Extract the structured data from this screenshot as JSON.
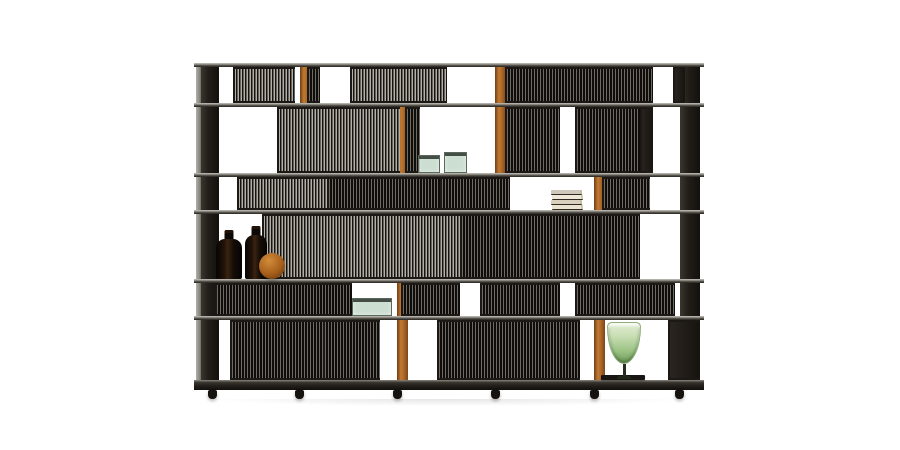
{
  "image_kind": "product-photograph",
  "subject": "modular slatted shelving room divider with decor objects on white background",
  "palette": {
    "background": "#ffffff",
    "frame_dark": "#2b2722",
    "end_panel": "#1f1b17",
    "shelf_top": "#c6c3bc",
    "shelf_face": "#55514b",
    "plinth": "#211d18",
    "slat_light": "#b2afa8",
    "slat_mid": "#6f6b63",
    "slat_gap": "#0f0d0b",
    "accent_orange": "#b06a2a",
    "bottle_glass": "#1a0f07",
    "wood_sphere": "#a9611c",
    "glass_teal": "#aac6b2",
    "book_cream": "#efe8d8",
    "vase_green": "#9cc384"
  },
  "scene": {
    "unit": {
      "left": 196,
      "top": 63,
      "width": 504,
      "height": 340
    },
    "uprights_dark": [
      {
        "x": 104,
        "w": 4
      },
      {
        "x": 201,
        "w": 4
      },
      {
        "x": 299,
        "w": 4
      },
      {
        "x": 398,
        "w": 4
      }
    ],
    "uprights_light": [
      {
        "x": 0,
        "w": 6
      }
    ],
    "end_panels": [
      {
        "x": 5,
        "w": 18
      },
      {
        "x": 484,
        "w": 20
      }
    ],
    "orange_posts": [
      {
        "x": 104,
        "y": 4,
        "h": 36
      },
      {
        "x": 104,
        "y": 151,
        "h": 102
      },
      {
        "x": 299,
        "y": 4,
        "h": 106
      },
      {
        "x": 201,
        "y": 44,
        "h": 103
      },
      {
        "x": 201,
        "y": 220,
        "h": 97
      },
      {
        "x": 398,
        "y": 114,
        "h": 203
      }
    ],
    "panels": [
      {
        "x": 37,
        "y": 4,
        "w": 62,
        "h": 36,
        "tone": "silver"
      },
      {
        "x": 111,
        "y": 4,
        "w": 13,
        "h": 36,
        "tone": "dark"
      },
      {
        "x": 154,
        "y": 4,
        "w": 97,
        "h": 36,
        "tone": "silver"
      },
      {
        "x": 309,
        "y": 4,
        "w": 148,
        "h": 36,
        "tone": "dark"
      },
      {
        "x": 477,
        "y": 4,
        "w": 12,
        "h": 36,
        "tone": "solid"
      },
      {
        "x": 81,
        "y": 44,
        "w": 123,
        "h": 66,
        "tone": "silver"
      },
      {
        "x": 209,
        "y": 44,
        "w": 15,
        "h": 66,
        "tone": "dark"
      },
      {
        "x": 309,
        "y": 44,
        "w": 55,
        "h": 66,
        "tone": "dark"
      },
      {
        "x": 379,
        "y": 44,
        "w": 65,
        "h": 66,
        "tone": "dark"
      },
      {
        "x": 444,
        "y": 44,
        "w": 13,
        "h": 66,
        "tone": "solid"
      },
      {
        "x": 41,
        "y": 114,
        "w": 90,
        "h": 33,
        "tone": "silver"
      },
      {
        "x": 131,
        "y": 114,
        "w": 113,
        "h": 33,
        "tone": "dark"
      },
      {
        "x": 244,
        "y": 114,
        "w": 70,
        "h": 33,
        "tone": "dark"
      },
      {
        "x": 406,
        "y": 114,
        "w": 48,
        "h": 33,
        "tone": "dark"
      },
      {
        "x": 66,
        "y": 151,
        "w": 198,
        "h": 65,
        "tone": "silver"
      },
      {
        "x": 264,
        "y": 151,
        "w": 140,
        "h": 65,
        "tone": "dark"
      },
      {
        "x": 404,
        "y": 151,
        "w": 40,
        "h": 65,
        "tone": "dark"
      },
      {
        "x": 19,
        "y": 220,
        "w": 137,
        "h": 33,
        "tone": "dark"
      },
      {
        "x": 205,
        "y": 220,
        "w": 59,
        "h": 33,
        "tone": "dark"
      },
      {
        "x": 284,
        "y": 220,
        "w": 80,
        "h": 33,
        "tone": "dark"
      },
      {
        "x": 379,
        "y": 220,
        "w": 100,
        "h": 33,
        "tone": "dark"
      },
      {
        "x": 34,
        "y": 257,
        "w": 93,
        "h": 60,
        "tone": "dark"
      },
      {
        "x": 127,
        "y": 257,
        "w": 57,
        "h": 60,
        "tone": "dark"
      },
      {
        "x": 241,
        "y": 257,
        "w": 143,
        "h": 60,
        "tone": "dark"
      },
      {
        "x": 472,
        "y": 257,
        "w": 32,
        "h": 60,
        "tone": "solid"
      }
    ],
    "shelves": [
      {
        "y": 0,
        "h": 4,
        "kind": "shelf"
      },
      {
        "y": 40,
        "h": 4,
        "kind": "shelf"
      },
      {
        "y": 110,
        "h": 4,
        "kind": "shelf"
      },
      {
        "y": 147,
        "h": 4,
        "kind": "shelf"
      },
      {
        "y": 216,
        "h": 4,
        "kind": "shelf"
      },
      {
        "y": 253,
        "h": 4,
        "kind": "shelf"
      },
      {
        "y": 317,
        "h": 10,
        "kind": "plinth"
      }
    ],
    "feet": [
      {
        "x": 12
      },
      {
        "x": 99
      },
      {
        "x": 197
      },
      {
        "x": 295
      },
      {
        "x": 394
      },
      {
        "x": 479
      }
    ],
    "objects": [
      {
        "type": "bottle",
        "name": "dark-glass-bottle",
        "x": 20,
        "y": 167,
        "w": 26,
        "h": 49
      },
      {
        "type": "bottle",
        "name": "dark-glass-bottle",
        "x": 49,
        "y": 163,
        "w": 22,
        "h": 53
      },
      {
        "type": "sphere",
        "name": "wooden-sphere",
        "x": 63,
        "y": 190,
        "w": 26,
        "h": 26
      },
      {
        "type": "glassbox",
        "name": "teal-glass-box",
        "x": 222,
        "y": 92,
        "w": 22,
        "h": 18
      },
      {
        "type": "glassbox",
        "name": "teal-glass-box",
        "x": 248,
        "y": 89,
        "w": 23,
        "h": 21
      },
      {
        "type": "books",
        "name": "book-stack",
        "x": 355,
        "y": 124,
        "w": 32,
        "h": 23,
        "count": 4
      },
      {
        "type": "glassbox",
        "name": "teal-glass-box",
        "x": 156,
        "y": 235,
        "w": 40,
        "h": 18
      },
      {
        "type": "mat",
        "name": "dark-tray-mat",
        "x": 405,
        "y": 312,
        "w": 44,
        "h": 5
      },
      {
        "type": "goblet",
        "name": "green-glass-vase",
        "x": 411,
        "y": 259,
        "w": 34,
        "h": 57
      }
    ],
    "book_colors": [
      "#cfc9bd",
      "#efe8d8",
      "#d9d1bd",
      "#e9e2d0"
    ]
  }
}
